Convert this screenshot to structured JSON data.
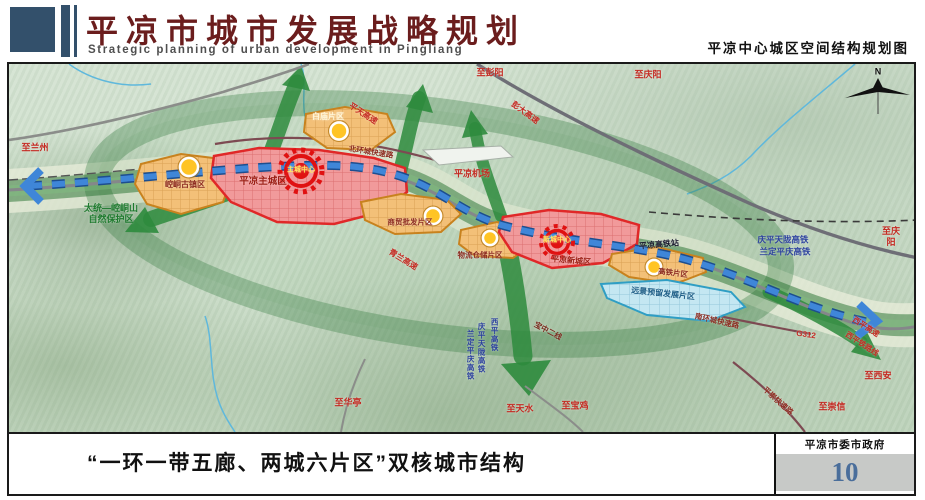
{
  "header": {
    "title_cn": "平凉市城市发展战略规划",
    "title_en": "Strategic planning of urban development in Pingliang",
    "map_subtitle": "平凉中心城区空间结构规划图"
  },
  "footer": {
    "caption": "“一环一带五廊、两城六片区”双核城市结构",
    "agency": "平凉市委市政府",
    "page_number": "10"
  },
  "colors": {
    "header_block": "#33506b",
    "title_red": "#6b1d1d",
    "road_label_red": "#c42a22",
    "rail_label_blue": "#2a3f9e",
    "reserve_green": "#1e7a2e",
    "zone_label_maroon": "#8d2b20",
    "core_text_yellow": "#ffe95c",
    "page_number_blue": "#4a6e9b"
  },
  "map": {
    "labels": [
      {
        "id": "zhi-lanzhou",
        "text": "至兰州",
        "x": 26,
        "y": 84,
        "c": "#c42a22",
        "s": 9
      },
      {
        "id": "nature-reserve",
        "text": "太统—崆峒山\n自然保护区",
        "x": 102,
        "y": 150,
        "c": "#1e7a2e",
        "s": 9
      },
      {
        "id": "zone-kongtong",
        "text": "崆峒古镇区",
        "x": 176,
        "y": 121,
        "c": "#8d2b20",
        "s": 8
      },
      {
        "id": "zone-main-city",
        "text": "平凉主城区",
        "x": 254,
        "y": 118,
        "c": "#9c1f15",
        "s": 9.5
      },
      {
        "id": "core-main-city",
        "text": "主城中心",
        "x": 292,
        "y": 107,
        "c": "#ffe95c",
        "s": 7
      },
      {
        "id": "zone-baimiao",
        "text": "白庙片区",
        "x": 319,
        "y": 53,
        "c": "#fff6d8",
        "s": 8
      },
      {
        "id": "pingtian-expwy",
        "text": "平天高速",
        "x": 354,
        "y": 50,
        "c": "#c42a22",
        "s": 8,
        "r": 33
      },
      {
        "id": "zhi-pengyang",
        "text": "至彭阳",
        "x": 481,
        "y": 9,
        "c": "#c42a22",
        "s": 9
      },
      {
        "id": "pengda-expwy",
        "text": "彭大高速",
        "x": 516,
        "y": 49,
        "c": "#c42a22",
        "s": 8,
        "r": 36
      },
      {
        "id": "zhi-qingyang-top",
        "text": "至庆阳",
        "x": 639,
        "y": 11,
        "c": "#c42a22",
        "s": 9
      },
      {
        "id": "north-ring-road",
        "text": "北环城快速路",
        "x": 362,
        "y": 88,
        "c": "#8d2b20",
        "s": 7.5,
        "r": 9
      },
      {
        "id": "airport",
        "text": "平凉机场",
        "x": 463,
        "y": 110,
        "c": "#c42a22",
        "s": 9
      },
      {
        "id": "qinglan-expwy",
        "text": "青兰高速",
        "x": 394,
        "y": 196,
        "c": "#c42a22",
        "s": 8,
        "r": 32
      },
      {
        "id": "zone-shangmao",
        "text": "商贸批发片区",
        "x": 401,
        "y": 158,
        "c": "#8d2b20",
        "s": 7.5
      },
      {
        "id": "zone-wuliu",
        "text": "物流仓储片区",
        "x": 471,
        "y": 191,
        "c": "#8d2b20",
        "s": 7.5
      },
      {
        "id": "core-new-city",
        "text": "新城中心",
        "x": 548,
        "y": 177,
        "c": "#ffe95c",
        "s": 7
      },
      {
        "id": "zone-new-city",
        "text": "平凉新城区",
        "x": 562,
        "y": 197,
        "c": "#9c1f15",
        "s": 8,
        "r": 5
      },
      {
        "id": "hsr-station",
        "text": "平凉高铁站",
        "x": 650,
        "y": 181,
        "c": "#15152a",
        "s": 8,
        "r": -5
      },
      {
        "id": "zone-gaotie",
        "text": "高铁片区",
        "x": 664,
        "y": 209,
        "c": "#8d2b20",
        "s": 7.5,
        "r": 7
      },
      {
        "id": "zone-reserve",
        "text": "远景预留发展片区",
        "x": 654,
        "y": 230,
        "c": "#1d5d86",
        "s": 8,
        "r": 6
      },
      {
        "id": "qptl-hsr",
        "text": "庆平天陇高铁",
        "x": 774,
        "y": 176,
        "c": "#2a3f9e",
        "s": 8.5
      },
      {
        "id": "ldpq-hsr",
        "text": "兰定平庆高铁",
        "x": 776,
        "y": 188,
        "c": "#2a3f9e",
        "s": 8.5
      },
      {
        "id": "zhi-qingyang-right",
        "text": "至庆阳",
        "x": 882,
        "y": 173,
        "c": "#c42a22",
        "s": 9
      },
      {
        "id": "south-ring-road",
        "text": "南环城快速路",
        "x": 708,
        "y": 257,
        "c": "#8d2b20",
        "s": 7.5,
        "r": 13
      },
      {
        "id": "g312",
        "text": "G312",
        "x": 797,
        "y": 271,
        "c": "#c42a22",
        "s": 8,
        "r": 8
      },
      {
        "id": "xiping-expwy",
        "text": "西平高速",
        "x": 857,
        "y": 263,
        "c": "#c42a22",
        "s": 7.5,
        "r": 33
      },
      {
        "id": "xiping-rail",
        "text": "西平铁路线",
        "x": 853,
        "y": 280,
        "c": "#c42a22",
        "s": 7.5,
        "r": 33
      },
      {
        "id": "zhi-xian",
        "text": "至西安",
        "x": 869,
        "y": 312,
        "c": "#c42a22",
        "s": 9
      },
      {
        "id": "zhi-chongxin",
        "text": "至崇信",
        "x": 823,
        "y": 343,
        "c": "#c42a22",
        "s": 9
      },
      {
        "id": "pingchong-road",
        "text": "平崇快速路",
        "x": 769,
        "y": 337,
        "c": "#8d2b20",
        "s": 7.5,
        "r": 42
      },
      {
        "id": "zhi-huating",
        "text": "至华亭",
        "x": 339,
        "y": 339,
        "c": "#c42a22",
        "s": 9
      },
      {
        "id": "zhi-tianshui",
        "text": "至天水",
        "x": 511,
        "y": 345,
        "c": "#c42a22",
        "s": 9
      },
      {
        "id": "zhi-baoji",
        "text": "至宝鸡",
        "x": 566,
        "y": 342,
        "c": "#c42a22",
        "s": 9
      },
      {
        "id": "ldpq-hsr-vertical",
        "text": "兰定平庆高铁",
        "x": 461,
        "y": 291,
        "c": "#2a3f9e",
        "s": 7.5,
        "v": true
      },
      {
        "id": "qptl-hsr-vertical",
        "text": "庆平天陇高铁",
        "x": 472,
        "y": 284,
        "c": "#2a3f9e",
        "s": 7.5,
        "v": true
      },
      {
        "id": "xiping-hsr-vertical",
        "text": "西平高铁",
        "x": 485,
        "y": 271,
        "c": "#2a3f9e",
        "s": 7.5,
        "v": true
      },
      {
        "id": "baozhong-line",
        "text": "宝中二线",
        "x": 539,
        "y": 267,
        "c": "#7a2a1e",
        "s": 7.5,
        "r": 28
      },
      {
        "id": "compass-n",
        "text": "N",
        "x": 869,
        "y": 8,
        "c": "#111111",
        "s": 9
      }
    ]
  }
}
